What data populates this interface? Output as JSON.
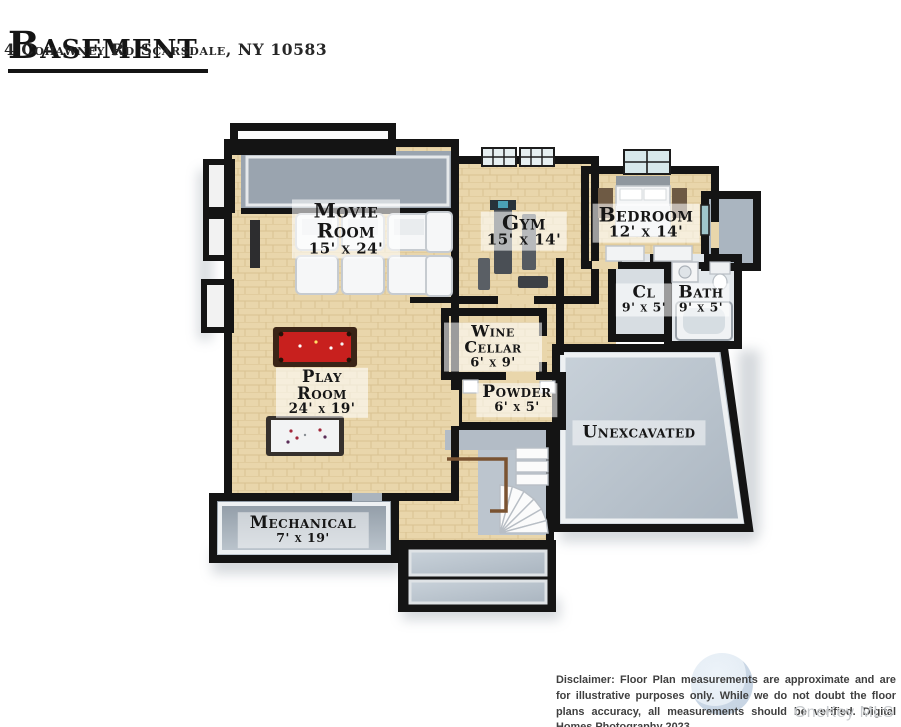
{
  "header": {
    "title": "Basement",
    "address": "4 Cohawney Rd Scarsdale, NY 10583"
  },
  "floorplan": {
    "rooms": [
      {
        "id": "movie-room",
        "name": "Movie Room",
        "dims": "15' x 24'"
      },
      {
        "id": "gym",
        "name": "Gym",
        "dims": "15' x 14'"
      },
      {
        "id": "bedroom",
        "name": "Bedroom",
        "dims": "12' x 14'"
      },
      {
        "id": "closet",
        "name": "Cl",
        "dims": "9' x 5'"
      },
      {
        "id": "bath",
        "name": "Bath",
        "dims": "9' x 5'"
      },
      {
        "id": "wine-cellar",
        "name": "Wine Cellar",
        "dims": "6' x 9'"
      },
      {
        "id": "powder",
        "name": "Powder",
        "dims": "6' x 5'"
      },
      {
        "id": "play-room",
        "name": "Play Room",
        "dims": "24' x 19'"
      },
      {
        "id": "unexcavated",
        "name": "Unexcavated",
        "dims": ""
      },
      {
        "id": "mechanical",
        "name": "Mechanical",
        "dims": "7' x 19'"
      }
    ],
    "furniture_visible": [
      "home-theater-seating",
      "tv",
      "pool-table",
      "air-hockey-table",
      "exercise-equipment",
      "double-bed",
      "nightstand-benches",
      "dressers",
      "vanity-sink",
      "toilet",
      "bathtub",
      "winder-staircase",
      "stair-railing",
      "windows"
    ],
    "colors": {
      "wall": "#141414",
      "wood_floor": "#e9d6ab",
      "wood_floor_dark": "#dcc492",
      "gray_floor": "#b7c1cb",
      "soffit_gray": "#9aa4af",
      "pool_table_felt": "#c8201e",
      "pool_table_frame": "#3a2417",
      "railing_brown": "#7a5331",
      "window_glass": "#d7e8eb",
      "label_background": "rgba(255,255,255,0.58)"
    }
  },
  "footer": {
    "disclaimer": "Disclaimer: Floor Plan measurements are approximate and are for illustrative purposes only. While we do not doubt the floor plans accuracy, all measurements should be verified. Digital Homes Photography 2023.",
    "mls_watermark": "OneKey MLS"
  }
}
